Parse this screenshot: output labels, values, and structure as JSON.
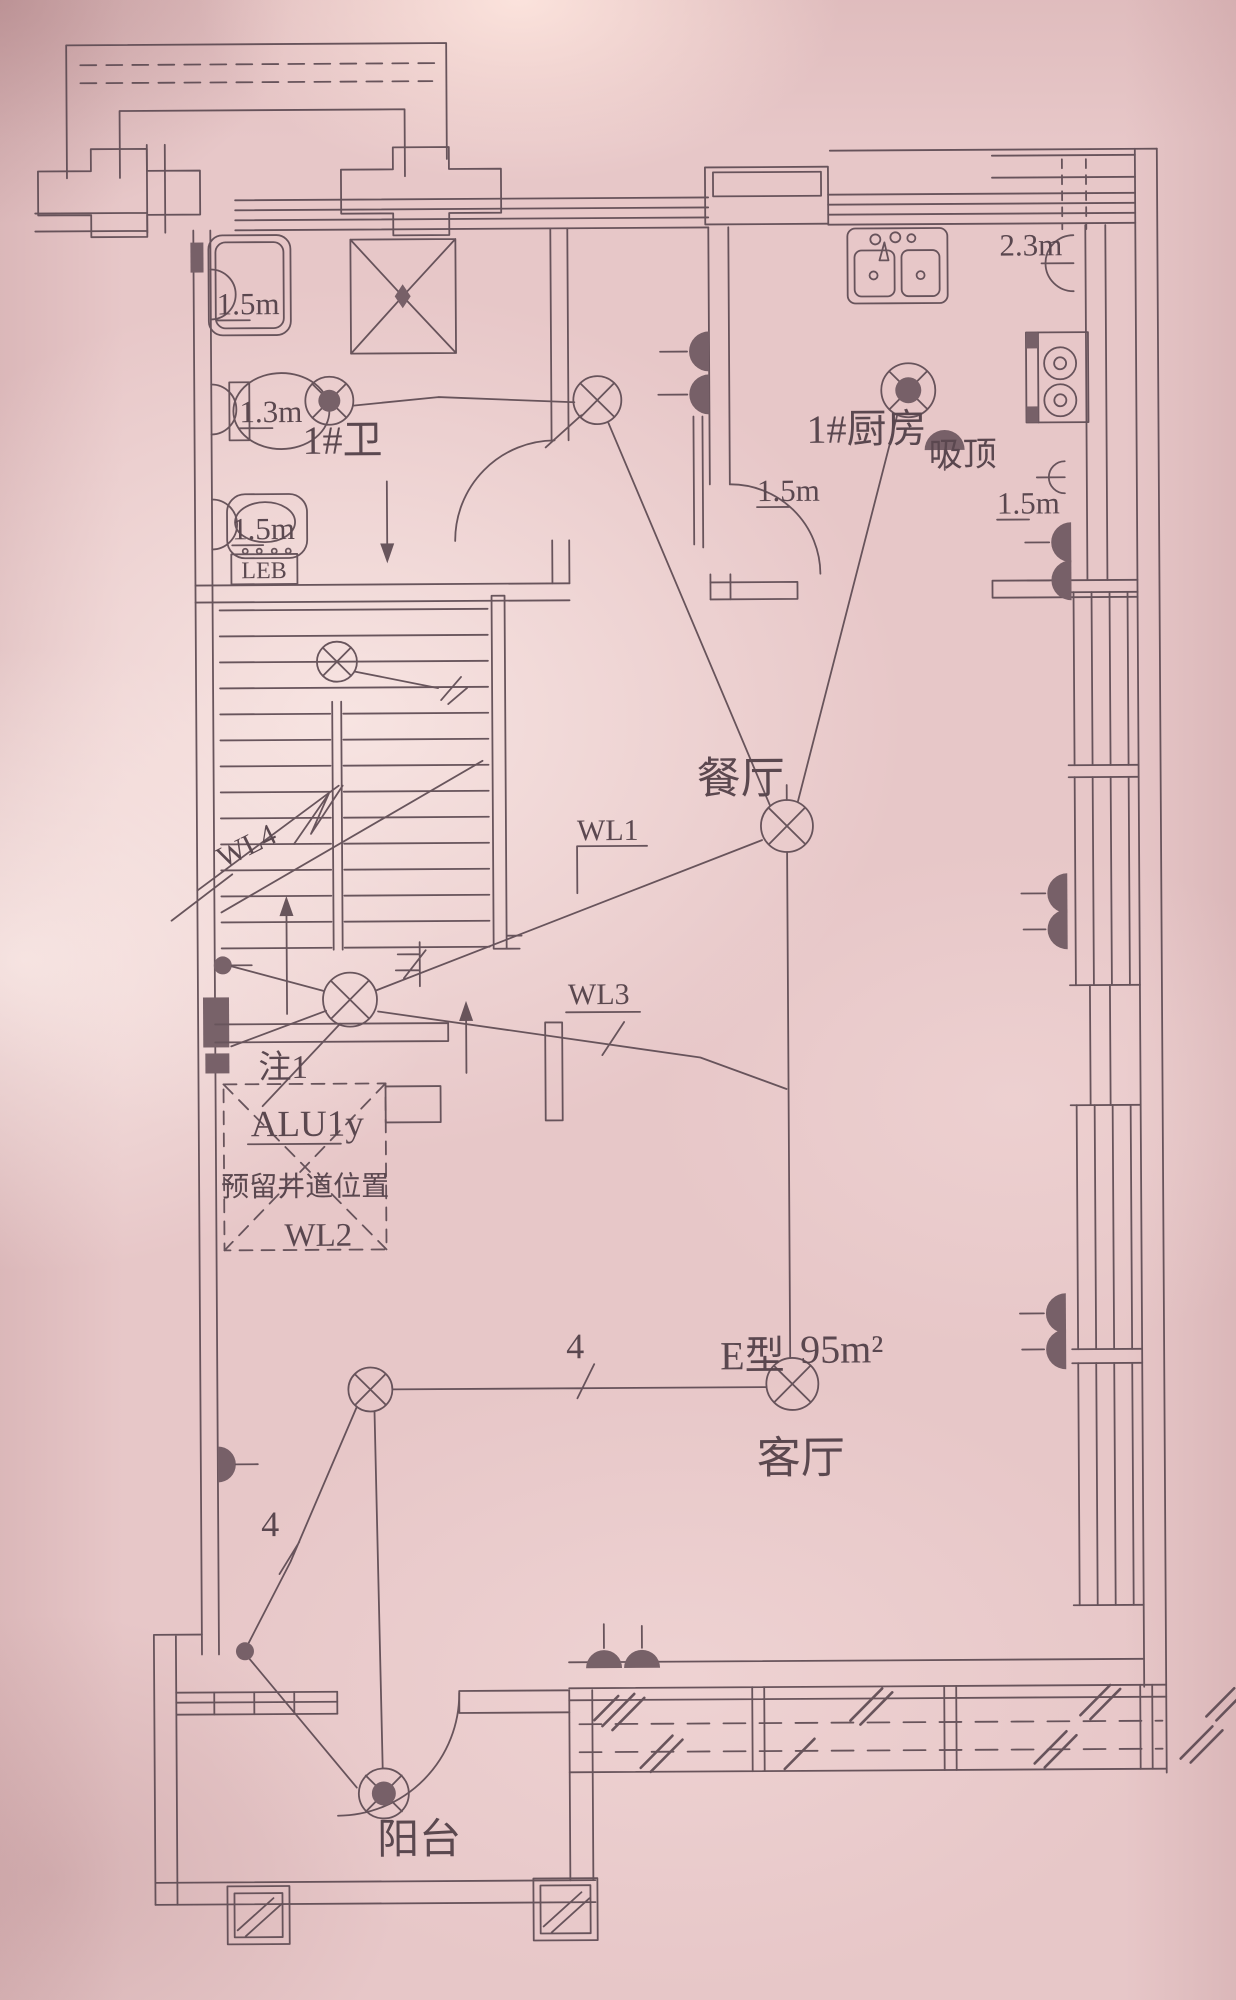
{
  "labels": {
    "bathroom_name": "1#卫",
    "bathroom_shower_dim": "1.5m",
    "bathroom_toilet_dim": "1.3m",
    "bathroom_basin_dim": "1.5m",
    "bathroom_leb": "LEB",
    "kitchen_name": "1#厨房",
    "kitchen_ceiling_note": "吸顶",
    "kitchen_dim_top_right": "2.3m",
    "kitchen_dim_left": "1.5m",
    "kitchen_dim_right": "1.5m",
    "dining_name": "餐厅",
    "living_name": "客厅",
    "balcony_name": "阳台",
    "unit_type": "E型",
    "unit_area": "95m²",
    "note1": "注1",
    "panel_circuit": "ALU1y",
    "shaft_note": "预留井道位置",
    "wl1": "WL1",
    "wl2": "WL2",
    "wl3": "WL3",
    "wl4": "WL4",
    "wire_count_living": "4",
    "wire_count_balcony": "4"
  },
  "colors": {
    "paper": "#e7c7c8",
    "ink": "#5d4a52",
    "text": "#4f3d45",
    "device_fill": "#6e5860"
  },
  "symbols": {
    "pendant_light": "circle-with-x",
    "ceiling_light": "circle-with-spokes-solid-center",
    "wall_socket": "solid-half-circle",
    "wall_lamp": "open-half-circle",
    "distribution_box": "solid-rectangle",
    "reserved_shaft": "dashed-box-with-x"
  }
}
